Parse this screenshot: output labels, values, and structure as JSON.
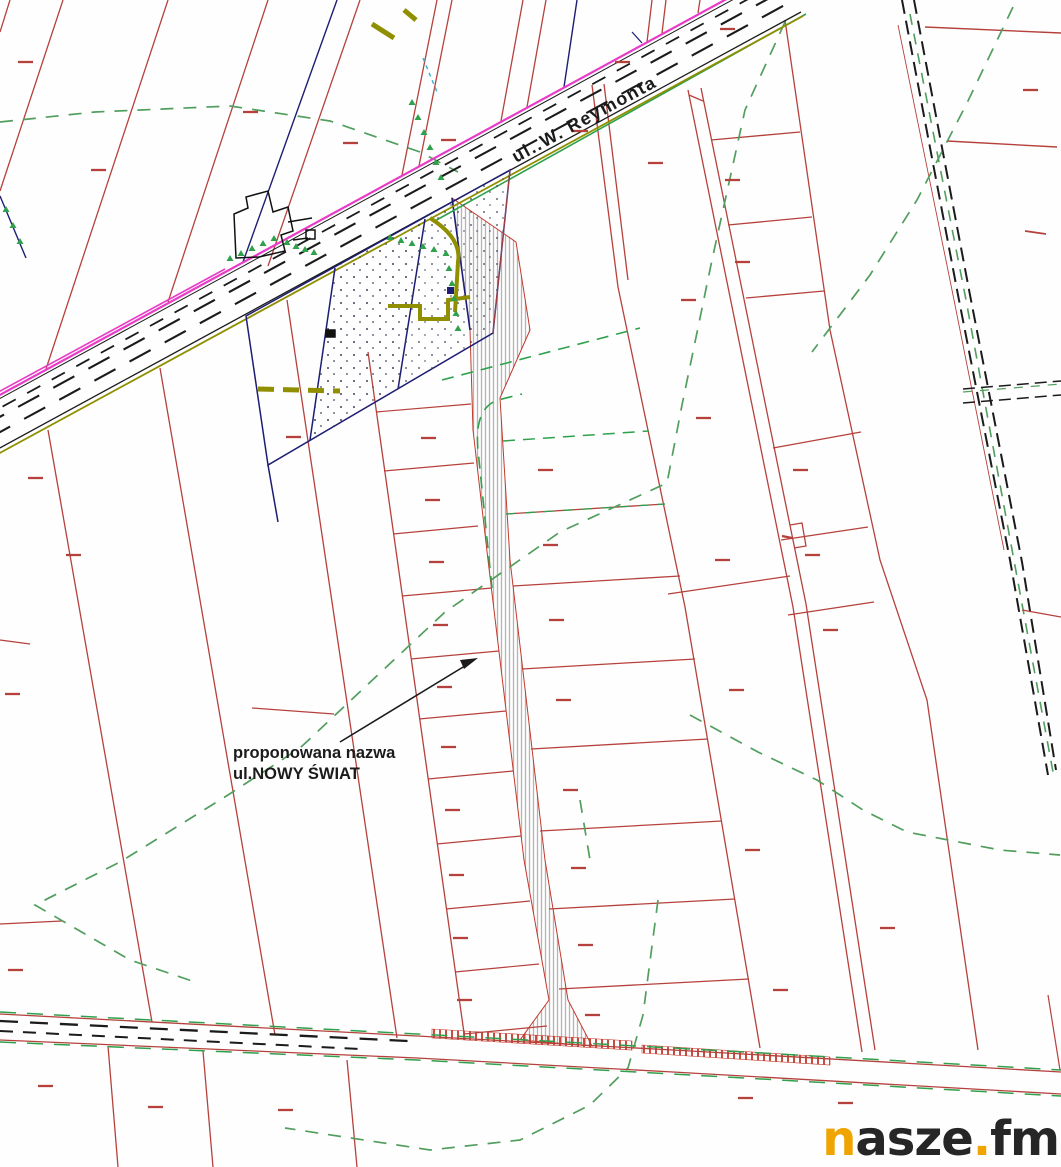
{
  "map": {
    "street_label": "ul..W. Reymonta",
    "annotation_line1": "proponowana nazwa",
    "annotation_line2": "ul.NOWY ŚWIAT"
  },
  "watermark": {
    "part1": "n",
    "part2": "asze",
    "part3": ".",
    "part4": "fm"
  },
  "colors": {
    "parcel_red": "#b5413c",
    "contour_green": "#519e5e",
    "design_green": "#2fa14d",
    "road_magenta": "#e83bc7",
    "utility_olive": "#8f8f00",
    "cadastre_navy": "#1d1d73",
    "hatch_gray": "#b4b4b4",
    "stripe_red": "#c0392b",
    "ink_black": "#1b1b1b",
    "cyan_line": "#3cb4d4",
    "watermark_orange": "#EFA400",
    "watermark_dark": "#262626"
  }
}
